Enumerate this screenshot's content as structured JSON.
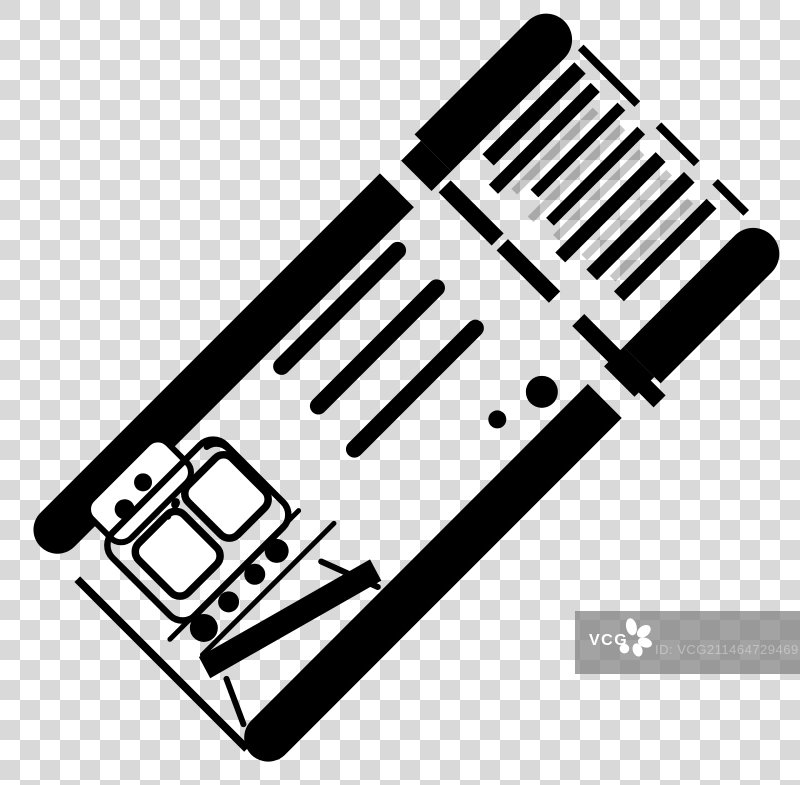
{
  "background": {
    "type": "transparency-checkerboard",
    "checker_light": "#ffffff",
    "checker_dark": "#d9d9d9",
    "square_px": 20
  },
  "icon": {
    "subject": "tilted train ticket with barcode, dashed tear line, text lines and train front",
    "color": "#000000",
    "gray_stripe": "rgba(0,0,0,0.22)",
    "rotation_deg": -45
  },
  "watermark": {
    "brand": "VCG",
    "id_label": "ID: VCG211464729469",
    "bar_color": "rgba(128,128,128,0.72)",
    "brand_color": "#ffffff",
    "id_color": "rgba(255,255,255,0.35)"
  }
}
